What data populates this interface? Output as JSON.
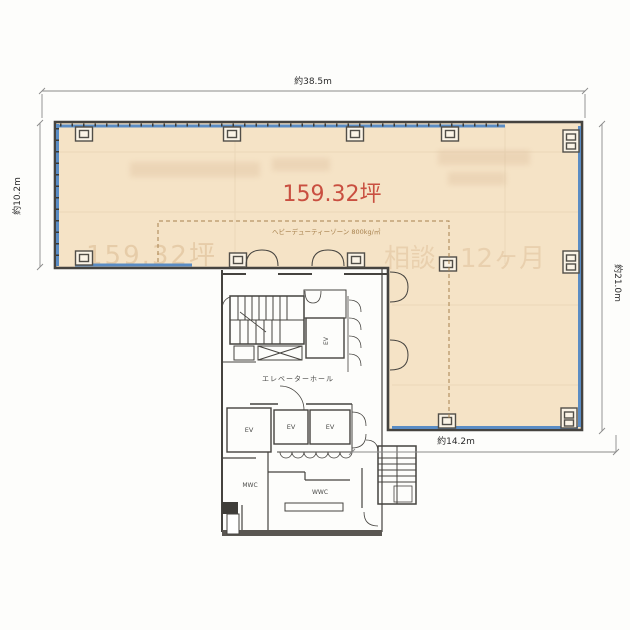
{
  "plan": {
    "dimensions": {
      "width_top": "約38.5m",
      "height_left": "約10.2m",
      "height_right": "約21.0m",
      "width_bottom": "約14.2m"
    },
    "area_label": "159.32坪",
    "heavy_duty_label": "ヘビーデューティーゾーン 800kg/㎡",
    "labels": {
      "elevator_hall": "エレベーターホール",
      "ev": "EV",
      "mwc": "MWC",
      "wwc": "WWC"
    },
    "watermarks": {
      "area_ghost": "159.32坪",
      "negotiable_ghost": "相談",
      "months_ghost": "12ヶ月"
    },
    "colors": {
      "floor": "#f5e3c6",
      "window": "#5a8cc4",
      "area_text": "#c94f40",
      "wall": "#45433f",
      "heavy_duty": "#a8824e",
      "ghost": "#cfa77a"
    }
  }
}
